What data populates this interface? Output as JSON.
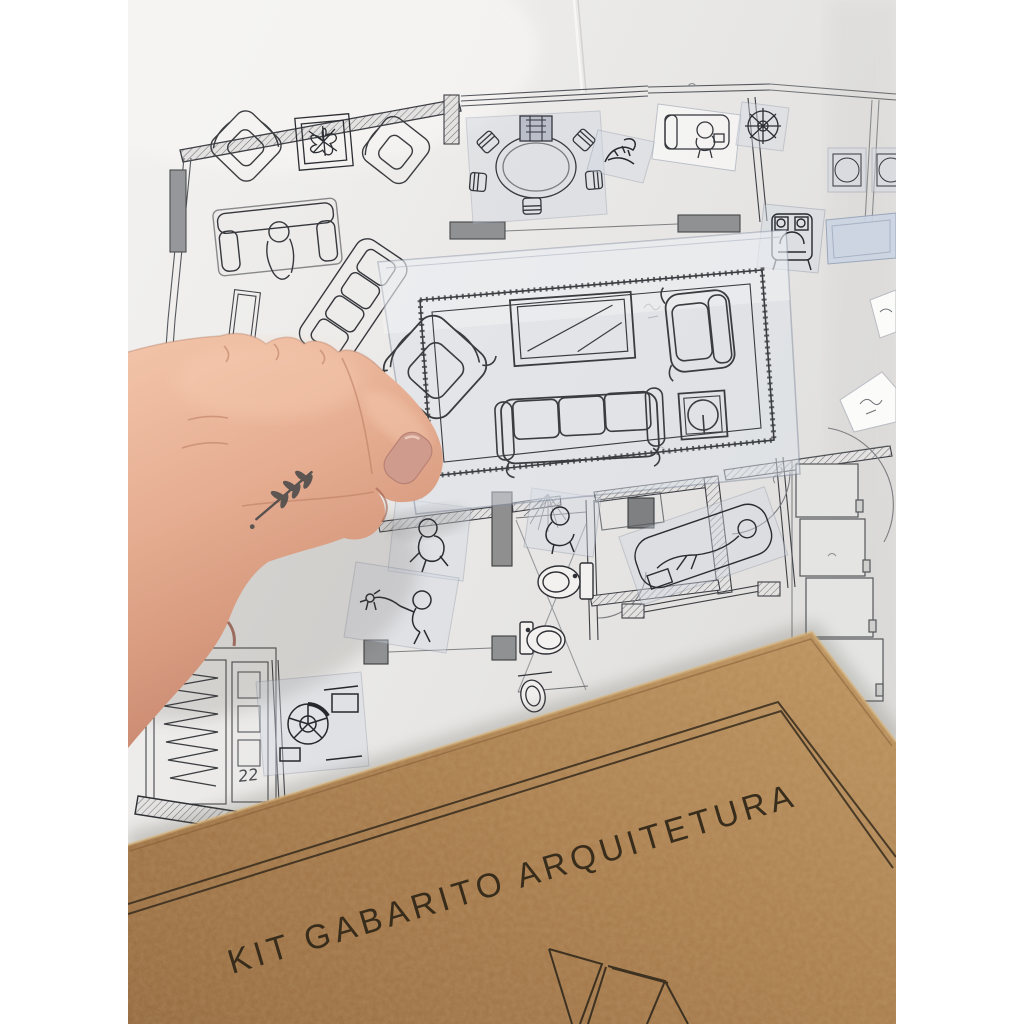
{
  "canvas": {
    "background": "#ffffff"
  },
  "photo": {
    "description": "Top-down photograph of a hand holding a transparent furniture template sheet over a printed apartment floor plan, with a kraft MDF kit cover lying across the bottom-right corner",
    "paper_color": "#e9e8e6",
    "plan_ink_color": "#3c3e42",
    "handwritten_note": "22"
  },
  "template_sheet": {
    "material": "transparent-film",
    "furniture": [
      "area-rug",
      "tv-panel",
      "rotated-armchair",
      "armchair",
      "three-seat-sofa",
      "lamp-side-table"
    ]
  },
  "stickers": {
    "items": [
      "dining-table-with-six-chairs",
      "potted-plant-scribble",
      "sofa-with-person-reading",
      "round-plant",
      "square-side-table",
      "square-side-table",
      "blue-rectangle",
      "compact-armchair",
      "person-seated",
      "person-walking-dog",
      "person-on-lounger",
      "person-at-sink",
      "office-chair-and-desk"
    ]
  },
  "floor_plan": {
    "rooms": [
      "living-room",
      "dining-room",
      "bathroom",
      "bathroom",
      "bedroom",
      "closet",
      "hall"
    ],
    "fixtures": [
      "toilet",
      "toilet",
      "washbasin",
      "wardrobe-modules",
      "closet-racks",
      "door-swings",
      "window-bands"
    ]
  },
  "hand": {
    "skin_tone": "#e3ab90",
    "nail_color": "#cf9b8d",
    "tattoo": "twig-with-leaves",
    "tattoo_color": "#474747"
  },
  "kraft_cover": {
    "title": "KIT GABARITO ARQUITETURA",
    "board_color": "#aa7c4b",
    "print_color": "#2e2517",
    "decoration": "isometric-furniture-line-drawing"
  }
}
